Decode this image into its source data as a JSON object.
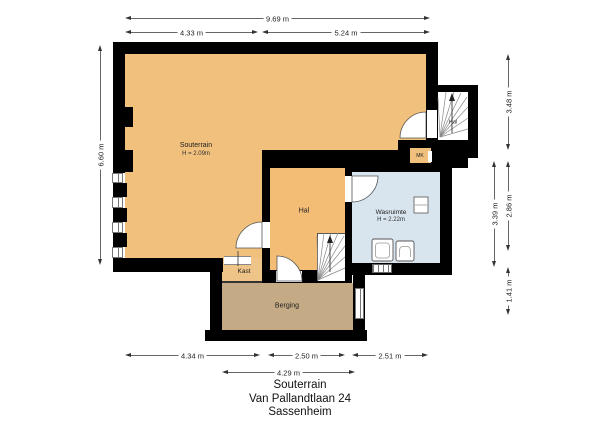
{
  "rooms": {
    "souterrain": {
      "label": "Souterrain",
      "height": "H = 2.09m"
    },
    "hal": {
      "label": "Hal"
    },
    "hal_upper": {
      "label": "Hal"
    },
    "wasruimte": {
      "label": "Wasruimte",
      "height": "H = 2.22m"
    },
    "kast": {
      "label": "Kast"
    },
    "meterkast": {
      "label": "MK"
    },
    "berging": {
      "label": "Berging"
    }
  },
  "dims": {
    "total_width": "9.69 m",
    "width_left": "4.33 m",
    "width_right": "5.24 m",
    "height_left": "6.60 m",
    "right_upper": "3.48 m",
    "right_middle_outer": "3.39 m",
    "right_middle_inner": "2.86 m",
    "right_lower": "1.41 m",
    "bottom_souterrain": "4.34 m",
    "bottom_hal": "2.50 m",
    "bottom_wasruimte": "2.51 m",
    "bottom_berging": "4.29 m"
  },
  "title": {
    "floor": "Souterrain",
    "address": "Van Pallandtlaan 24",
    "city": "Sassenheim"
  },
  "colors": {
    "room_tan": "#f0c07c",
    "room_blue": "#d9e5ee",
    "room_storage": "#c4ab86",
    "wall": "#000000",
    "background": "#ffffff"
  }
}
